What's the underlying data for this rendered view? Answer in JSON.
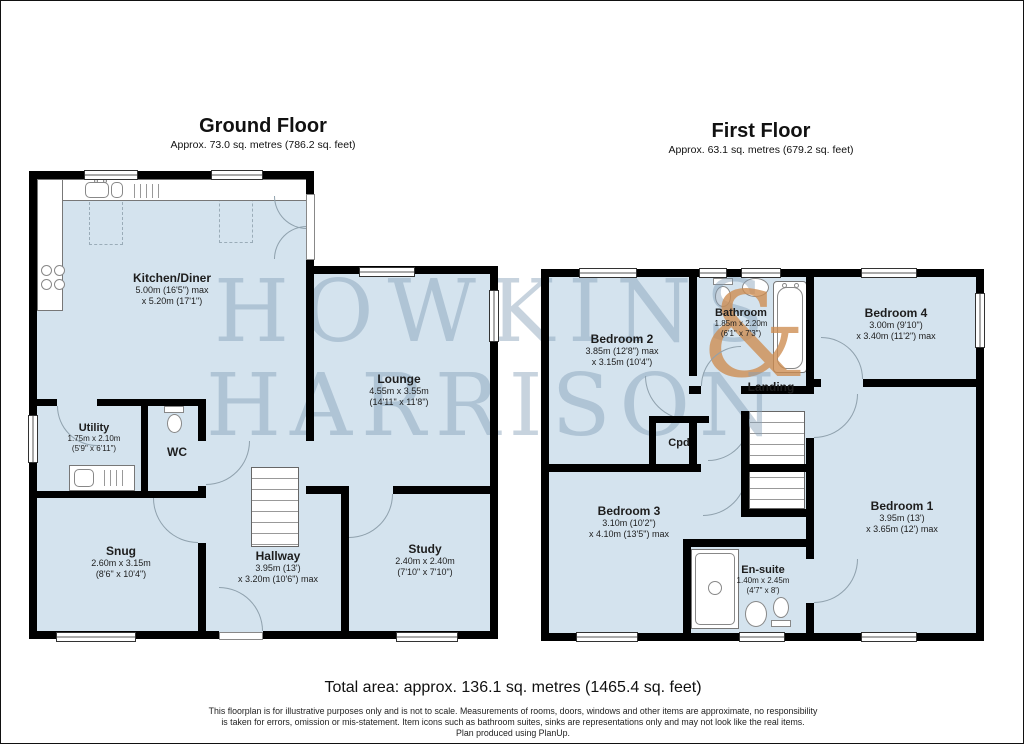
{
  "colors": {
    "room_fill": "#d4e3ee",
    "wall": "#000000",
    "watermark": "#829eb6",
    "ampersand": "#cd8c50"
  },
  "watermark": {
    "line1": "HOWKINS",
    "ampersand": "&",
    "line2": "HARRISON"
  },
  "ground_floor": {
    "title": "Ground Floor",
    "subtitle": "Approx. 73.0 sq. metres (786.2 sq. feet)",
    "rooms": {
      "kitchen_diner": {
        "name": "Kitchen/Diner",
        "dim1": "5.00m (16'5\") max",
        "dim2": "x 5.20m (17'1\")"
      },
      "lounge": {
        "name": "Lounge",
        "dim1": "4.55m x 3.55m",
        "dim2": "(14'11\" x 11'8\")"
      },
      "utility": {
        "name": "Utility",
        "dim1": "1.75m x 2.10m",
        "dim2": "(5'9\" x 6'11\")"
      },
      "wc": {
        "name": "WC"
      },
      "snug": {
        "name": "Snug",
        "dim1": "2.60m x 3.15m",
        "dim2": "(8'6\" x 10'4\")"
      },
      "hallway": {
        "name": "Hallway",
        "dim1": "3.95m (13')",
        "dim2": "x 3.20m (10'6\") max"
      },
      "study": {
        "name": "Study",
        "dim1": "2.40m x 2.40m",
        "dim2": "(7'10\" x 7'10\")"
      }
    }
  },
  "first_floor": {
    "title": "First Floor",
    "subtitle": "Approx. 63.1 sq. metres (679.2 sq. feet)",
    "rooms": {
      "bedroom_2": {
        "name": "Bedroom 2",
        "dim1": "3.85m (12'8\") max",
        "dim2": "x 3.15m (10'4\")"
      },
      "bathroom": {
        "name": "Bathroom",
        "dim1": "1.85m x 2.20m",
        "dim2": "(6'1\" x 7'3\")"
      },
      "bedroom_4": {
        "name": "Bedroom 4",
        "dim1": "3.00m (9'10\")",
        "dim2": "x 3.40m (11'2\") max"
      },
      "landing": {
        "name": "Landing"
      },
      "cpd": {
        "name": "Cpd"
      },
      "bedroom_3": {
        "name": "Bedroom 3",
        "dim1": "3.10m (10'2\")",
        "dim2": "x 4.10m (13'5\") max"
      },
      "bedroom_1": {
        "name": "Bedroom 1",
        "dim1": "3.95m (13')",
        "dim2": "x 3.65m (12') max"
      },
      "en_suite": {
        "name": "En-suite",
        "dim1": "1.40m x 2.45m",
        "dim2": "(4'7\" x 8')"
      }
    }
  },
  "footer": {
    "total_area": "Total area: approx. 136.1 sq. metres (1465.4 sq. feet)",
    "disclaimer_line1": "This floorplan is for illustrative purposes only and is not to scale. Measurements of rooms, doors, windows and other items are approximate, no responsibility",
    "disclaimer_line2": "is taken for errors, omission or mis-statement. Item icons such as bathroom suites, sinks are representations only and may not look like the real items.",
    "disclaimer_line3": "Plan produced using PlanUp."
  }
}
